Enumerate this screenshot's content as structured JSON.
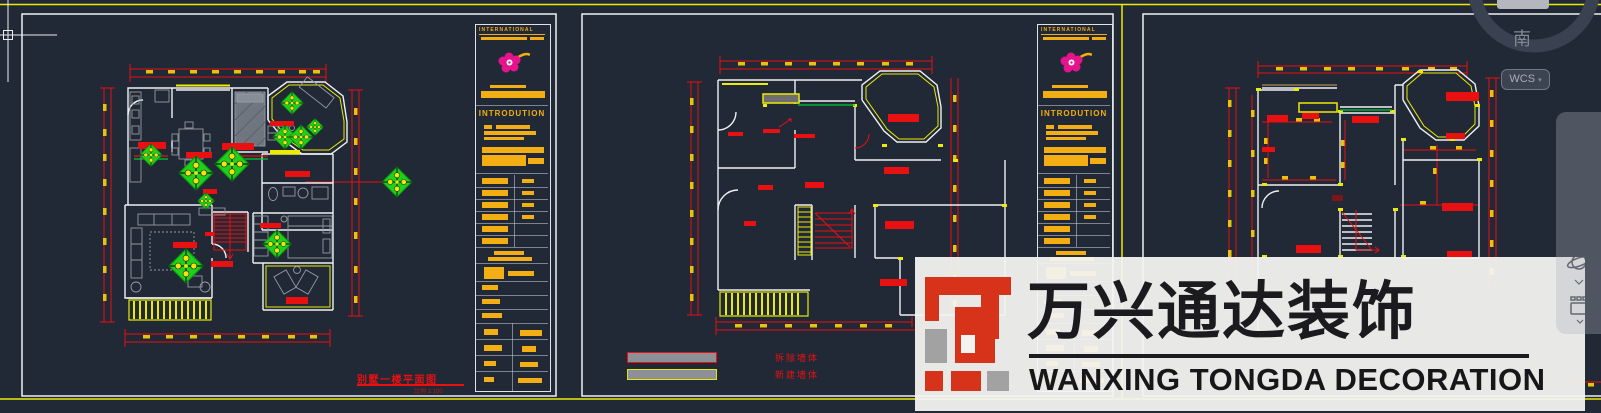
{
  "app": {
    "background": "#222936",
    "frame_color": "#ebeb06"
  },
  "cursor": {
    "type": "crosshair"
  },
  "viewcube": {
    "south_label": "南",
    "wcs_label": "WCS",
    "wcs_dropdown": "▾"
  },
  "nav_bar": {
    "icons": [
      "steering-wheel",
      "pan-hand",
      "zoom",
      "orbit",
      "show-motion"
    ]
  },
  "sheets": [
    {
      "id": "sheet-1",
      "kind": "furnished floor plan",
      "title": "别墅一楼平面图",
      "scale_note": "比例 1:100",
      "title_block": {
        "header": "INTERNATIONAL",
        "intro": "INTRODUTION"
      }
    },
    {
      "id": "sheet-2",
      "kind": "demolition plan",
      "legend": [
        {
          "label": "拆除墙体",
          "swatch_outline": "#e81010"
        },
        {
          "label": "新建墙体",
          "swatch_outline": "#e8e60a"
        }
      ],
      "title_block": {
        "header": "INTERNATIONAL",
        "intro": "INTRODUTION"
      }
    },
    {
      "id": "sheet-3",
      "kind": "dimensioned floor plan"
    }
  ],
  "watermark": {
    "cn": "万兴通达装饰",
    "en": "WANXING TONGDA DECORATION",
    "logo_red": "#d6331a",
    "logo_gray": "#a2a2a2"
  },
  "colors": {
    "line_red": "#e81010",
    "line_yellow": "#ebeb06",
    "tick_gold": "#e8c20c",
    "title_block_gold": "#f2ae12",
    "marker_green": "#1dd11d",
    "flower_magenta": "#e6148c",
    "wall_white": "#eef1f4",
    "furniture_gray": "#949aa2"
  }
}
